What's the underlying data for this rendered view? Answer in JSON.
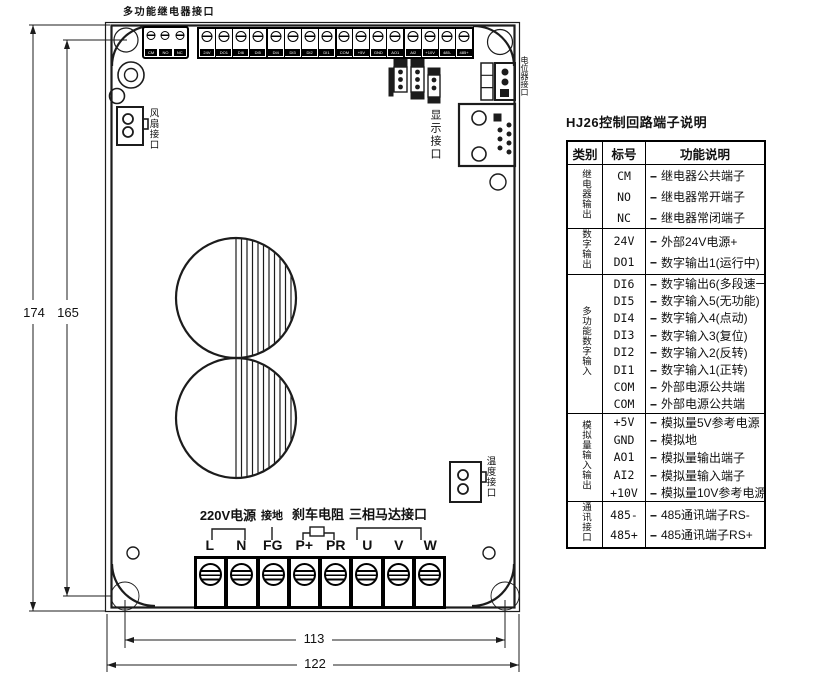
{
  "drawing": {
    "labels": {
      "relay_interface": "多功能继电器接口",
      "fan": "风扇接口",
      "display": "显示接口",
      "potentiometer": "电位器接口",
      "temperature": "温度接口"
    },
    "relay_terminals": [
      "CM",
      "NO",
      "NC"
    ],
    "io_terminals": [
      "24V",
      "DO1",
      "DI6",
      "DI5",
      "DI4",
      "DI3",
      "DI2",
      "DI1",
      "COM",
      "+5V",
      "GND",
      "AO1",
      "AI2",
      "+10V",
      "485-",
      "485+"
    ],
    "power_annotations": {
      "mains": "220V电源",
      "ground": "接地",
      "brake": "刹车电阻",
      "motor": "三相马达接口"
    },
    "power_terminals": [
      "L",
      "N",
      "FG",
      "P+",
      "PR",
      "U",
      "V",
      "W"
    ],
    "dimensions": {
      "height_outer": "174",
      "height_holes": "165",
      "width_holes": "113",
      "width_outer": "122"
    }
  },
  "table": {
    "title": "HJ26控制回路端子说明",
    "headers": [
      "类别",
      "标号",
      "功能说明"
    ],
    "dash": "--",
    "groups": [
      {
        "category": "继电器输出",
        "rows": [
          {
            "tag": "CM",
            "desc": "继电器公共端子"
          },
          {
            "tag": "NO",
            "desc": "继电器常开端子"
          },
          {
            "tag": "NC",
            "desc": "继电器常闭端子"
          }
        ]
      },
      {
        "category": "数字输出",
        "rows": [
          {
            "tag": "24V",
            "desc": "外部24V电源+"
          },
          {
            "tag": "DO1",
            "desc": "数字输出1(运行中)"
          }
        ]
      },
      {
        "category": "多功能数字输入",
        "rows": [
          {
            "tag": "DI6",
            "desc": "数字输出6(多段速一)"
          },
          {
            "tag": "DI5",
            "desc": "数字输入5(无功能)"
          },
          {
            "tag": "DI4",
            "desc": "数字输入4(点动)"
          },
          {
            "tag": "DI3",
            "desc": "数字输入3(复位)"
          },
          {
            "tag": "DI2",
            "desc": "数字输入2(反转)"
          },
          {
            "tag": "DI1",
            "desc": "数字输入1(正转)"
          },
          {
            "tag": "COM",
            "desc": "外部电源公共端"
          },
          {
            "tag": "COM",
            "desc": "外部电源公共端"
          }
        ]
      },
      {
        "category": "模拟量输入输出",
        "rows": [
          {
            "tag": "+5V",
            "desc": "模拟量5V参考电源"
          },
          {
            "tag": "GND",
            "desc": "模拟地"
          },
          {
            "tag": "AO1",
            "desc": "模拟量输出端子"
          },
          {
            "tag": "AI2",
            "desc": "模拟量输入端子"
          },
          {
            "tag": "+10V",
            "desc": "模拟量10V参考电源"
          }
        ]
      },
      {
        "category": "通讯接口",
        "rows": [
          {
            "tag": "485-",
            "desc": "485通讯端子RS-"
          },
          {
            "tag": "485+",
            "desc": "485通讯端子RS+"
          }
        ]
      }
    ]
  }
}
